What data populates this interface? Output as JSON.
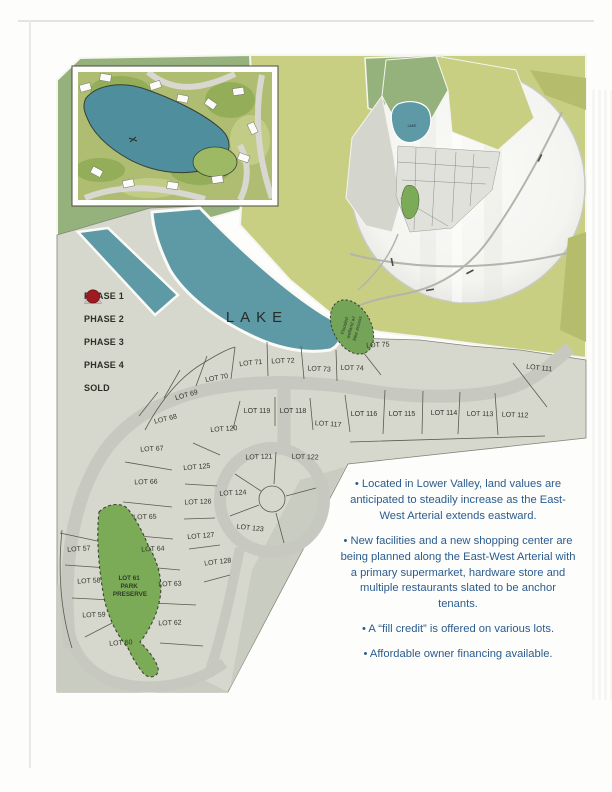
{
  "legend": {
    "items": [
      {
        "label": "PHASE 1",
        "shape": "triangle",
        "fill": "#f4f4f0",
        "stroke": "#3b3b33"
      },
      {
        "label": "PHASE 2",
        "shape": "triangle",
        "fill": "#ccd184",
        "stroke": "#bcc277"
      },
      {
        "label": "PHASE 3",
        "shape": "triangle",
        "fill": "#a9c48e",
        "stroke": "#3b4a36"
      },
      {
        "label": "PHASE 4",
        "shape": "triangle",
        "fill": "#d2d4cc",
        "stroke": "#c3c5bd"
      },
      {
        "label": "SOLD",
        "shape": "circle",
        "fill": "#9e1b21",
        "stroke": "#7c151a"
      }
    ]
  },
  "map": {
    "lake_label": "LAKE",
    "mini_lake_label": "LAKE",
    "wetland_lines": [
      "Flooded",
      "wetland w/",
      "lake access"
    ],
    "park_lines": [
      "LOT 61",
      "PARK",
      "PRESERVE"
    ],
    "lots": [
      {
        "label": "LOT 57",
        "x": 79,
        "y": 551,
        "rot": -4
      },
      {
        "label": "LOT 58",
        "x": 89,
        "y": 583,
        "rot": -3
      },
      {
        "label": "LOT 59",
        "x": 94,
        "y": 617,
        "rot": -2
      },
      {
        "label": "LOT 60",
        "x": 121,
        "y": 645,
        "rot": -4
      },
      {
        "label": "LOT 62",
        "x": 170,
        "y": 625,
        "rot": -2
      },
      {
        "label": "LOT 63",
        "x": 170,
        "y": 586,
        "rot": -2
      },
      {
        "label": "LOT 64",
        "x": 153,
        "y": 551,
        "rot": -3
      },
      {
        "label": "LOT 65",
        "x": 145,
        "y": 519,
        "rot": -2
      },
      {
        "label": "LOT 66",
        "x": 146,
        "y": 484,
        "rot": -2
      },
      {
        "label": "LOT 67",
        "x": 152,
        "y": 451,
        "rot": -3
      },
      {
        "label": "LOT 68",
        "x": 166,
        "y": 421,
        "rot": -14
      },
      {
        "label": "LOT 69",
        "x": 187,
        "y": 397,
        "rot": -16
      },
      {
        "label": "LOT 70",
        "x": 217,
        "y": 380,
        "rot": -10
      },
      {
        "label": "LOT 71",
        "x": 251,
        "y": 365,
        "rot": -6
      },
      {
        "label": "LOT 72",
        "x": 283,
        "y": 363,
        "rot": -2
      },
      {
        "label": "LOT 73",
        "x": 319,
        "y": 371,
        "rot": 3
      },
      {
        "label": "LOT 74",
        "x": 352,
        "y": 370,
        "rot": 2
      },
      {
        "label": "LOT 75",
        "x": 378,
        "y": 347,
        "rot": -3
      },
      {
        "label": "LOT 111",
        "x": 539,
        "y": 370,
        "rot": 6
      },
      {
        "label": "LOT 112",
        "x": 515,
        "y": 417,
        "rot": 2
      },
      {
        "label": "LOT 113",
        "x": 480,
        "y": 416,
        "rot": 1
      },
      {
        "label": "LOT 114",
        "x": 444,
        "y": 415,
        "rot": 0
      },
      {
        "label": "LOT 115",
        "x": 402,
        "y": 416,
        "rot": 0
      },
      {
        "label": "LOT 116",
        "x": 364,
        "y": 416,
        "rot": 0
      },
      {
        "label": "LOT 117",
        "x": 328,
        "y": 426,
        "rot": 4
      },
      {
        "label": "LOT 118",
        "x": 293,
        "y": 413,
        "rot": 0
      },
      {
        "label": "LOT 119",
        "x": 257,
        "y": 413,
        "rot": 0
      },
      {
        "label": "LOT 120",
        "x": 224,
        "y": 431,
        "rot": -4
      },
      {
        "label": "LOT 121",
        "x": 259,
        "y": 459,
        "rot": -2
      },
      {
        "label": "LOT 122",
        "x": 305,
        "y": 459,
        "rot": 2
      },
      {
        "label": "LOT 123",
        "x": 250,
        "y": 530,
        "rot": 6
      },
      {
        "label": "LOT 124",
        "x": 233,
        "y": 495,
        "rot": -3
      },
      {
        "label": "LOT 125",
        "x": 197,
        "y": 469,
        "rot": -5
      },
      {
        "label": "LOT 126",
        "x": 198,
        "y": 504,
        "rot": -2
      },
      {
        "label": "LOT 127",
        "x": 201,
        "y": 538,
        "rot": -5
      },
      {
        "label": "LOT 128",
        "x": 218,
        "y": 564,
        "rot": -7
      }
    ]
  },
  "notes": {
    "text_color": "#2b5c8e",
    "bullets": [
      "• Located in Lower Valley, land values are anticipated to steadily increase as the East-West Arterial extends eastward.",
      "• New facilities and a new shopping center are being planned along the East-West Arterial with a primary supermarket, hardware store and multiple restaurants slated to be anchor tenants.",
      "• A “fill credit” is offered on various lots.",
      "• Affordable owner financing available."
    ]
  },
  "colors": {
    "lake": "#5e99a6",
    "olive": "#c9cf82",
    "olive_dark": "#b5bd6c",
    "green": "#96b27c",
    "land": "#d6d8cd",
    "land_shade": "#c9ccc0",
    "road": "#c7c9c0",
    "parcel_line": "#5a5b4f",
    "park": "#7cab58",
    "wetland": "#74a458",
    "sold": "#9e1b21"
  }
}
